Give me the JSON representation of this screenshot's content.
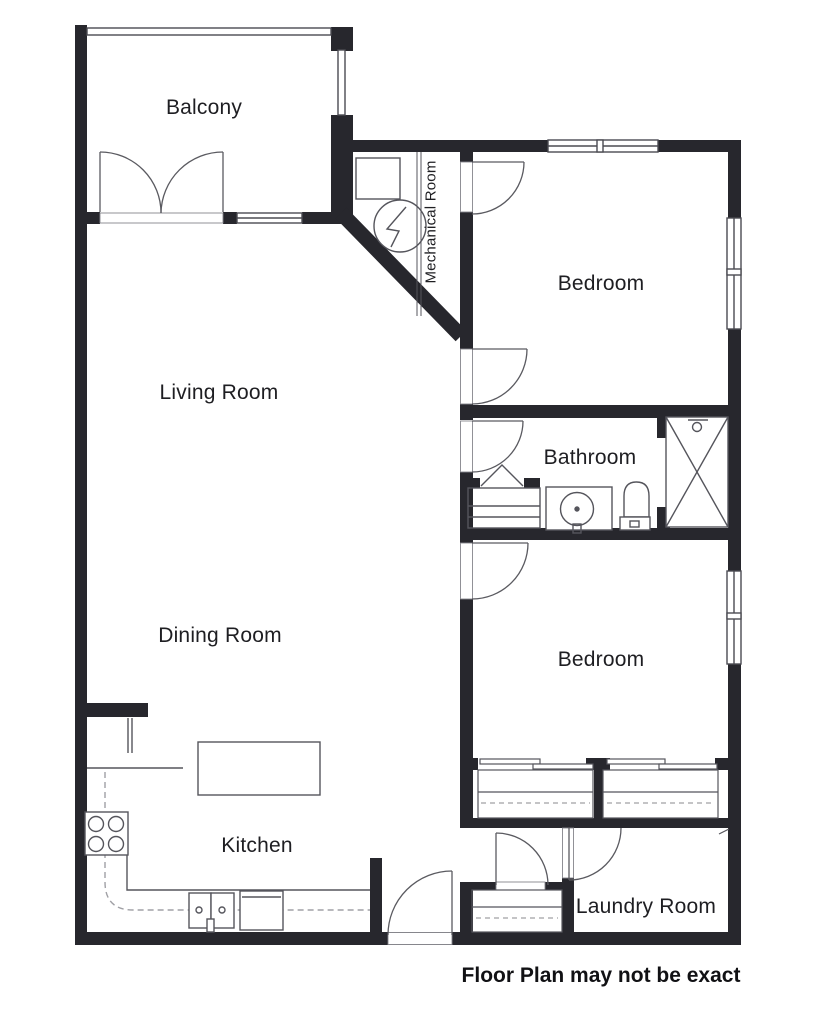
{
  "title": "Floor Plan",
  "rooms": {
    "balcony": {
      "label": "Balcony"
    },
    "living": {
      "label": "Living Room"
    },
    "dining": {
      "label": "Dining Room"
    },
    "kitchen": {
      "label": "Kitchen"
    },
    "mechanical": {
      "label": "Mechanical Room"
    },
    "bedroom1": {
      "label": "Bedroom"
    },
    "bathroom": {
      "label": "Bathroom"
    },
    "bedroom2": {
      "label": "Bedroom"
    },
    "laundry": {
      "label": "Laundry Room"
    }
  },
  "disclaimer": "Floor Plan may not be exact",
  "icons": {
    "stove": "stove-icon",
    "kitchen_sink": "kitchen-sink-icon",
    "dishwasher": "dishwasher-icon",
    "kitchen_island": "kitchen-island",
    "bathroom_sink": "bathroom-sink-icon",
    "toilet": "toilet-icon",
    "shower": "shower-icon",
    "electrical_panel": "electrical-panel-icon",
    "water_heater": "water-heater-icon",
    "french_doors": "french-doors-icon",
    "door_swing": "door-swing-icon",
    "window": "window-icon"
  },
  "colors": {
    "wall": "#27272d",
    "line": "#4b4b52",
    "door": "#5a5a60",
    "dashed": "#a0a0a5",
    "text": "#1e1e22",
    "background": "#ffffff"
  }
}
